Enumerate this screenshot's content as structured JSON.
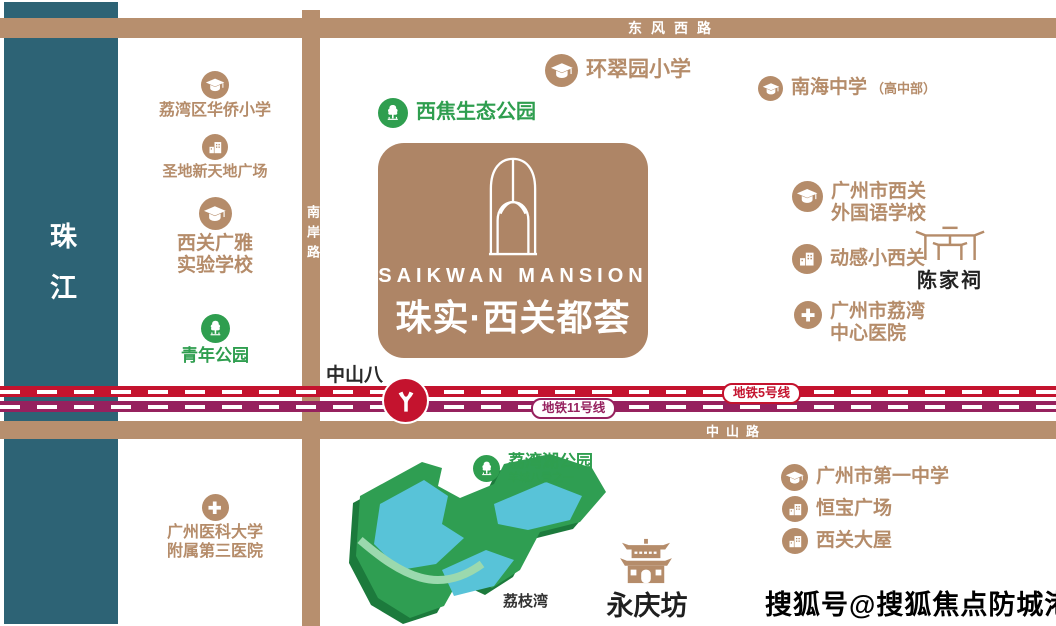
{
  "property": {
    "name_en": "SAIKWAN MANSION",
    "name_cn": "珠实·西关都荟"
  },
  "river": {
    "label": "珠江"
  },
  "roads": {
    "top": "东风西路",
    "side": "南岸路",
    "bottom": "中山路"
  },
  "metro": {
    "line5_label": "地铁5号线",
    "line11_label": "地铁11号线",
    "station_label": "中山八"
  },
  "pois": {
    "huaqiao_primary": "荔湾区华侨小学",
    "shengdi_plaza": "圣地新天地广场",
    "guangya_line1": "西关广雅",
    "guangya_line2": "实验学校",
    "qingnian_park": "青年公园",
    "yikeda_line1": "广州医科大学",
    "yikeda_line2": "附属第三医院",
    "xijiao_park": "西焦生态公园",
    "huancui_primary": "环翠园小学",
    "nanhai_school": "南海中学",
    "nanhai_suffix": "（高中部）",
    "xiguan_fl_line1": "广州市西关",
    "xiguan_fl_line2": "外国语学校",
    "donggan": "动感小西关",
    "chenjiaci": "陈家祠",
    "liwan_hosp_line1": "广州市荔湾",
    "liwan_hosp_line2": "中心医院",
    "yizhong": "广州市第一中学",
    "hengbao_plaza": "恒宝广场",
    "xiguan_dawu": "西关大屋",
    "lihuwan_park": "荔湾湖公园",
    "lihuwan_sub": "羊城八景之一",
    "lizhiwan": "荔枝湾",
    "yongqingfang": "永庆坊"
  },
  "colors": {
    "tan": "#b58c6a",
    "road": "#b78f6e",
    "card": "#ae8566",
    "green": "#2f9e4f",
    "park_green": "#2f9e52",
    "park_shadow": "#1c7a3c",
    "lake_blue": "#58c3d8",
    "metro_red": "#c4132e",
    "metro_purple": "#96215e",
    "river_teal": "#2d6375"
  },
  "watermark": "搜狐号@搜狐焦点防城港站"
}
